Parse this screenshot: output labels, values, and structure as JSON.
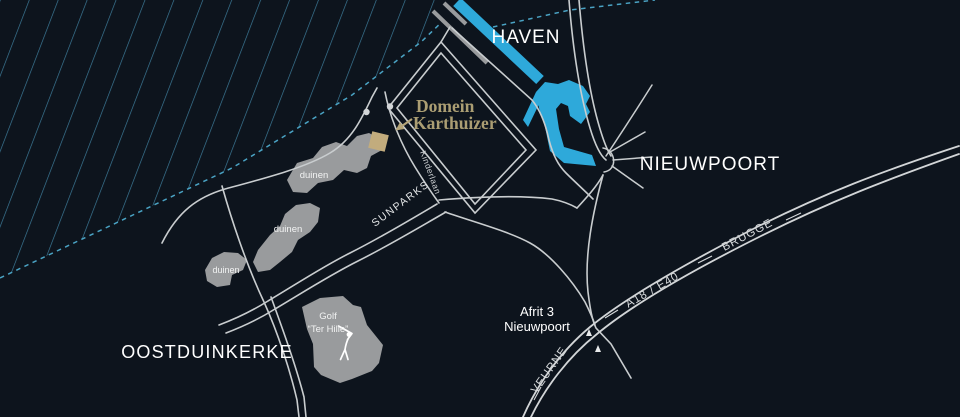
{
  "title": "Domein Karthuizer locatie kaart",
  "colors": {
    "background": "#0d141d",
    "water": "#2ea9da",
    "hatch": "#3e7f9e",
    "coastline": "#4aa3c4",
    "road": "#c9cdcf",
    "highway": "#d2d5d7",
    "area": "#999b9d",
    "accent": "#c2ac7d",
    "accent_text": "#ab9e73",
    "label": "#ffffff"
  },
  "labels": {
    "haven": "HAVEN",
    "nieuwpoort": "NIEUWPOORT",
    "oostduinkerke": "OOSTDUINKERKE",
    "domein_line1": "Domein",
    "domein_line2": "Karthuizer",
    "kinderlaan": "Kinderlaan",
    "sunparks": "SUNPARKS",
    "afrit_line1": "Afrit 3",
    "afrit_line2": "Nieuwpoort",
    "highway": "A18 / E40",
    "brugge": "BRUGGE",
    "veurne": "VEURNE",
    "duinen_1": "duinen",
    "duinen_2": "duinen",
    "duinen_3": "duinen",
    "golf_line1": "Golf",
    "golf_line2": "“Ter Hille”"
  }
}
